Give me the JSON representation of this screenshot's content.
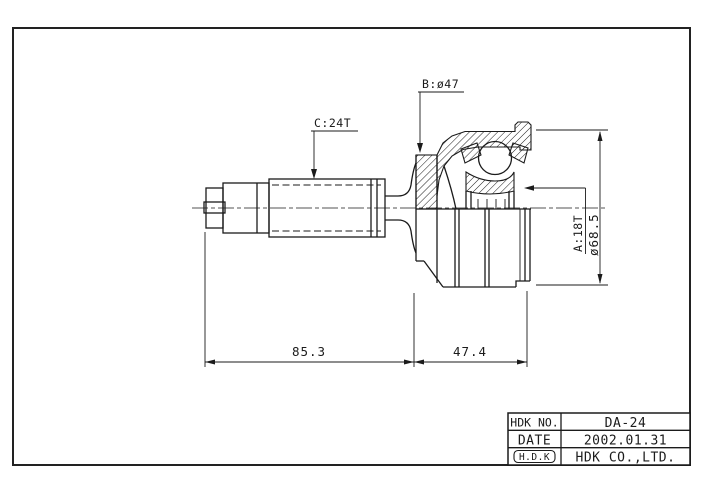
{
  "drawing": {
    "type": "engineering-half-section-drawing",
    "subject": "CV joint outboard assembly",
    "labels": {
      "c": "C:24T",
      "b": "B:ø47",
      "a": "A:18T",
      "dia": "ø68.5"
    },
    "dimensions": {
      "width_left": "85.3",
      "width_right": "47.4"
    },
    "colors": {
      "line": "#1b1b1b",
      "background": "#ffffff"
    }
  },
  "title_block": {
    "rows": [
      {
        "label": "HDK NO.",
        "value": "DA-24"
      },
      {
        "label": "DATE",
        "value": "2002.01.31"
      },
      {
        "label": "H.D.K",
        "value": "HDK CO.,LTD."
      }
    ]
  }
}
